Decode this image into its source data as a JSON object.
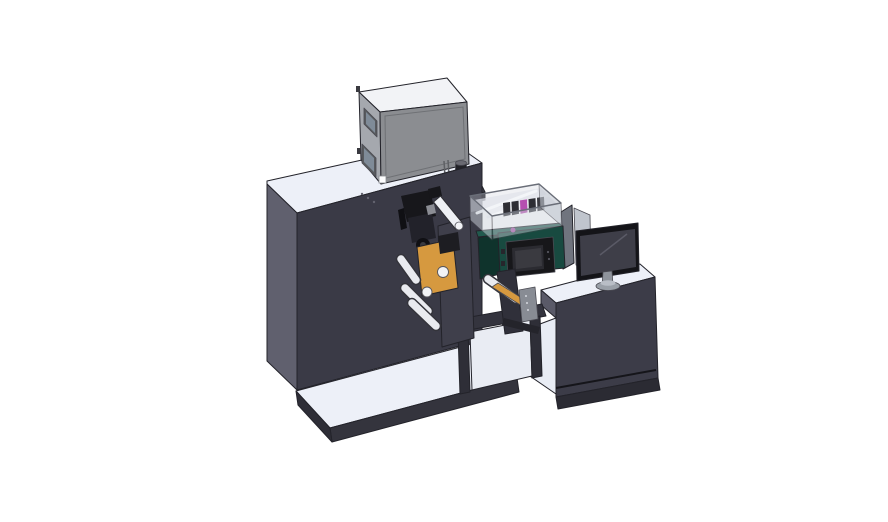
{
  "scene": {
    "background": "#ffffff"
  },
  "colors": {
    "surface_light": "#edf0f8",
    "tower_front": "#3a3a46",
    "tower_side": "#60606e",
    "platform_front": "#34343d",
    "platform_side": "#2e2e37",
    "box_top": "#f2f3f6",
    "box_side": "#a5a8ae",
    "box_front": "#8b8d91",
    "window_frame": "#585a5e",
    "window_glass": "#7f8b98",
    "label_white": "#fdfdfe",
    "hinge_dark": "#3a3a40",
    "pedestal_top": "#3f3f49",
    "pedestal_front": "#2c2c34",
    "cylinder_body": "#222227",
    "cylinder_cap": "#6a6a72",
    "cylinder_base": "#2a2a2f",
    "teal_front": "#184a40",
    "teal_side": "#0f332c",
    "teal_top": "#215a4e",
    "panel_black": "#17171a",
    "panel_rim": "#2b2b31",
    "panel_screen": "#3a3a40",
    "enclosure_wall": "#ccd2da",
    "enclosure_wall_right": "#c2c8d1",
    "enclosure_floor": "#dfe3ea",
    "strut_white": "#f4f6f9",
    "cartridge_dark": "#2e2e34",
    "cartridge_alt": "#3a3a40",
    "cartridge_magenta": "#b54fb0",
    "orange": "#d6993f",
    "orange_cap": "#1d1d22",
    "roller_white": "#e9eaef",
    "roller_face": "#eef0f4",
    "roller_end": "#f2f3f6",
    "mechanism_black": "#17171b",
    "mechanism_mid": "#22222a",
    "mechanism_deep": "#101014",
    "mechanism_light": "#8b8d94",
    "frame_plate": "#3f3f4b",
    "stand_dark": "#34343e",
    "stand_leg": "#2e2e37",
    "stand_interior": "#e9ecf3",
    "rewind_column": "#30303a",
    "rewind_bracket": "#888c94",
    "rewind_arm": "#24242b",
    "desk_front": "#3c3c48",
    "desk_side": "#5a5a68",
    "desk_base": "#2b2b33",
    "desk_bay": "#e8ecf4",
    "desk_leg": "#33333d",
    "divider_dark": "#70747e",
    "divider_light": "#c0c5cd",
    "monitor_bezel": "#141418",
    "monitor_screen": "#3e3e48",
    "monitor_stand": "#8e939b",
    "monitor_base": "#9aa0a8",
    "monitor_base_top": "#b9bec6",
    "dot_seam": "#63636f",
    "vent_dot": "#0d2a24",
    "clip_dark": "#26262c",
    "bracket_dot": "#d5d8dd",
    "panel_dot": "#55555e"
  }
}
